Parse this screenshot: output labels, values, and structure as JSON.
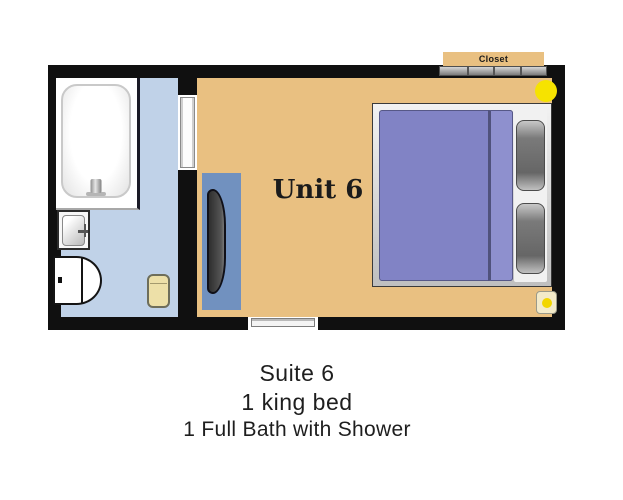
{
  "colors": {
    "wall": "#101010",
    "main-floor": "#e9c081",
    "bath-floor": "#c0d2e8",
    "mat": "#7191bf",
    "blanket": "#8183c5",
    "blanket-fold": "#8e90ce",
    "accent-yellow": "#f6e300",
    "bin": "#ede0a8"
  },
  "floorplan": {
    "room_label": "Unit 6",
    "closet_label": "Closet",
    "fixtures": [
      "bathtub",
      "sink",
      "toilet",
      "waste-bin",
      "bathroom-door",
      "bench-mat",
      "bench",
      "closet-sliding-doors",
      "ceiling-light",
      "king-bed",
      "pillows",
      "wall-switch",
      "entry-door"
    ]
  },
  "caption": {
    "line1": "Suite 6",
    "line2": "1 king bed",
    "line3": "1 Full Bath with Shower"
  }
}
